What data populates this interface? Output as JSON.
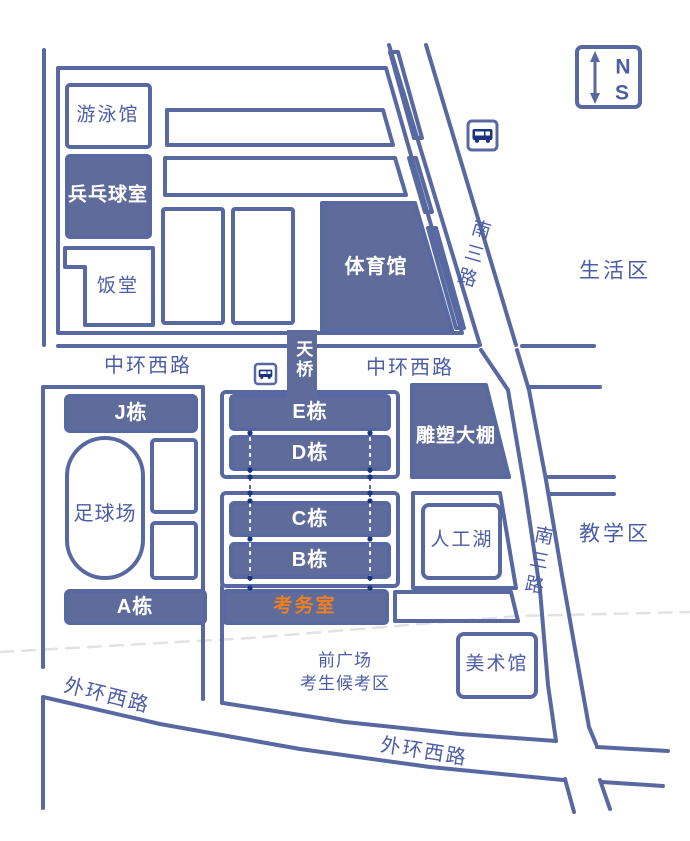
{
  "map": {
    "title": "校园考场平面示意图",
    "compass": {
      "north": "N",
      "south": "S"
    },
    "areas": {
      "living": "生活区",
      "teaching": "教学区"
    },
    "roads": {
      "nansan": "南三路",
      "zhonghuan_west": "中环西路",
      "waihuan_west": "外环西路"
    },
    "bridge": {
      "label": "天桥"
    },
    "buildings": {
      "natatorium": "游泳馆",
      "pingpong": "兵乓球室",
      "canteen": "饭堂",
      "gym": "体育馆",
      "block_j": "J栋",
      "block_e": "E栋",
      "block_d": "D栋",
      "block_c": "C栋",
      "block_b": "B栋",
      "block_a": "A栋",
      "exam_office": "考务室",
      "football_field": "足球场",
      "sculpture_shed": "雕塑大棚",
      "lake": "人工湖",
      "art_museum": "美术馆"
    },
    "plaza": {
      "line1": "前广场",
      "line2": "考生候考区"
    },
    "icons": {
      "bus_stop": "bus-icon",
      "compass": "compass-icon",
      "route_dots": "dashed-route-line"
    },
    "colors": {
      "line_blue": "#5868a0",
      "fill_blue": "#5f6c9b",
      "text_blue": "#4c5ca6",
      "accent_orange": "#ef7f1f",
      "icon_navy": "#1c347f",
      "faint_dash": "#e2e2e2"
    }
  }
}
